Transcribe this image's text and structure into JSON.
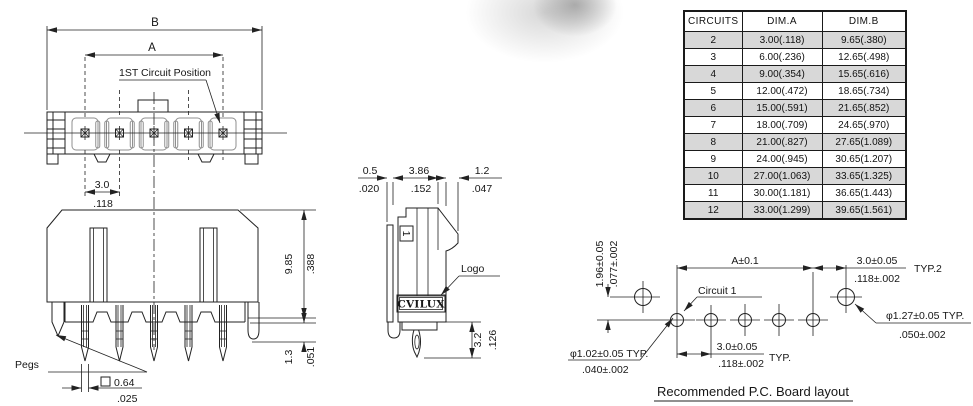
{
  "front_view": {
    "b_label": "B",
    "a_label": "A",
    "first_circuit_label": "1ST Circuit Position",
    "pitch_mm": "3.0",
    "pitch_in": ".118"
  },
  "side_view": {
    "pegs_label": "Pegs",
    "height_mm": "9.85",
    "height_in": ".388",
    "standoff_mm": "1.3",
    "standoff_in": ".051",
    "tail_square_mm": "0.64",
    "tail_square_in": ".025"
  },
  "profile_view": {
    "wall_mm": "0.5",
    "wall_in": ".020",
    "depth_mm": "3.86",
    "depth_in": ".152",
    "latch_mm": "1.2",
    "latch_in": ".047",
    "logo_label": "Logo",
    "logo_text": "CVILUX",
    "circuit_mark": "1",
    "tail_mm": "3.2",
    "tail_in": ".126"
  },
  "circuits_table": {
    "headers": [
      "CIRCUITS",
      "DIM.A",
      "DIM.B"
    ],
    "rows": [
      [
        "2",
        "3.00(.118)",
        "9.65(.380)"
      ],
      [
        "3",
        "6.00(.236)",
        "12.65(.498)"
      ],
      [
        "4",
        "9.00(.354)",
        "15.65(.616)"
      ],
      [
        "5",
        "12.00(.472)",
        "18.65(.734)"
      ],
      [
        "6",
        "15.00(.591)",
        "21.65(.852)"
      ],
      [
        "7",
        "18.00(.709)",
        "24.65(.970)"
      ],
      [
        "8",
        "21.00(.827)",
        "27.65(1.089)"
      ],
      [
        "9",
        "24.00(.945)",
        "30.65(1.207)"
      ],
      [
        "10",
        "27.00(1.063)",
        "33.65(1.325)"
      ],
      [
        "11",
        "30.00(1.181)",
        "36.65(1.443)"
      ],
      [
        "12",
        "33.00(1.299)",
        "39.65(1.561)"
      ]
    ]
  },
  "pcb_layout": {
    "title": "Recommended P.C. Board layout",
    "dim_a": "A±0.1",
    "end_pitch_mm": "3.0±0.05",
    "end_pitch_in": ".118±.002",
    "end_pitch_note": "TYP.2",
    "row_offset_mm": "1.96±0.05",
    "row_offset_in": ".077±.002",
    "circuit1_label": "Circuit 1",
    "small_hole_mm": "φ1.02±0.05 TYP.",
    "small_hole_in": ".040±.002",
    "pitch_mm": "3.0±0.05",
    "pitch_in": ".118±.002",
    "pitch_note": "TYP.",
    "large_hole_mm": "φ1.27±0.05 TYP.",
    "large_hole_in": ".050±.002"
  }
}
